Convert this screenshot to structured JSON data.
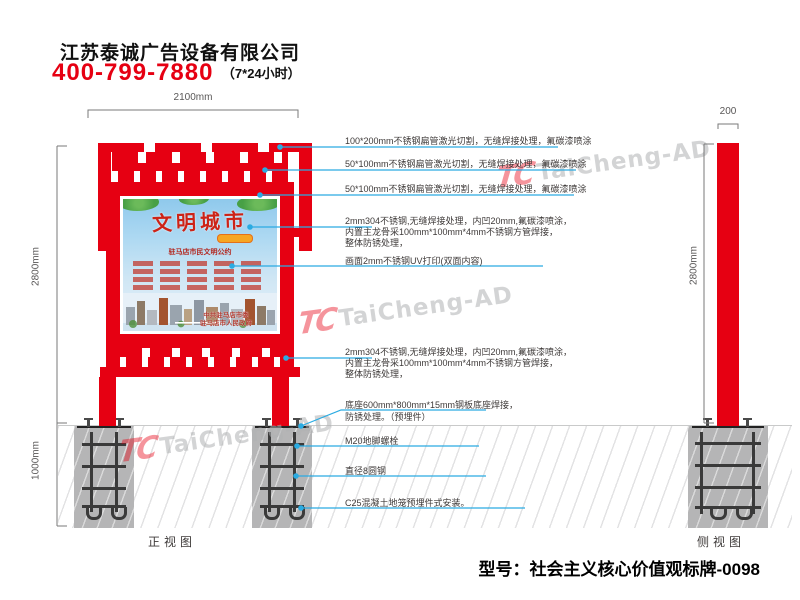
{
  "header": {
    "company": "江苏泰诚广告设备有限公司",
    "phone": "400-799-7880",
    "hours": "（7*24小时）"
  },
  "views": {
    "front_label": "正视图",
    "side_label": "侧视图"
  },
  "dimensions": {
    "front_width": "2100mm",
    "front_height": "2800mm",
    "foundation_depth": "1000mm",
    "side_width": "200",
    "side_height": "2800mm"
  },
  "annotations": [
    {
      "lines": [
        "100*200mm不锈钢扁管激光切割，无缝焊接处理，氟碳漆喷涂"
      ]
    },
    {
      "lines": [
        "50*100mm不锈钢扁管激光切割，无缝焊接处理，氟碳漆喷涂"
      ]
    },
    {
      "lines": [
        "50*100mm不锈钢扁管激光切割，无缝焊接处理，氟碳漆喷涂"
      ]
    },
    {
      "lines": [
        "2mm304不锈钢,无缝焊接处理，内凹20mm,氟碳漆喷涂，",
        "内置主龙骨采100mm*100mm*4mm不锈钢方管焊接，",
        "整体防锈处理，"
      ]
    },
    {
      "lines": [
        "画面2mm不锈钢UV打印(双面内容)"
      ]
    },
    {
      "lines": [
        "2mm304不锈钢,无缝焊接处理，内凹20mm,氟碳漆喷涂，",
        "内置主龙骨采100mm*100mm*4mm不锈钢方管焊接，",
        "整体防锈处理，"
      ]
    },
    {
      "lines": [
        "底座600mm*800mm*15mm钢板底座焊接，",
        "防锈处理。（预埋件）"
      ]
    },
    {
      "lines": [
        "M20地脚螺栓"
      ]
    },
    {
      "lines": [
        "直径8圆钢"
      ]
    },
    {
      "lines": [
        "C25混凝土地笼预埋件式安装。"
      ]
    }
  ],
  "poster": {
    "title": "文明城市",
    "subtitle": "驻马店市民文明公约",
    "org_line1": "中共驻马店市委",
    "org_line2": "驻马店市人民政府"
  },
  "watermark": {
    "logo": "TC",
    "text": "TaiCheng-AD"
  },
  "footer": {
    "model": "型号：社会主义核心价值观标牌-0098"
  },
  "colors": {
    "brand_red": "#e60012",
    "leader_blue": "#2aabe2",
    "concrete_grey": "#b5b5b6",
    "dim_grey": "#595757",
    "annotation_text": "#3e3a39"
  }
}
